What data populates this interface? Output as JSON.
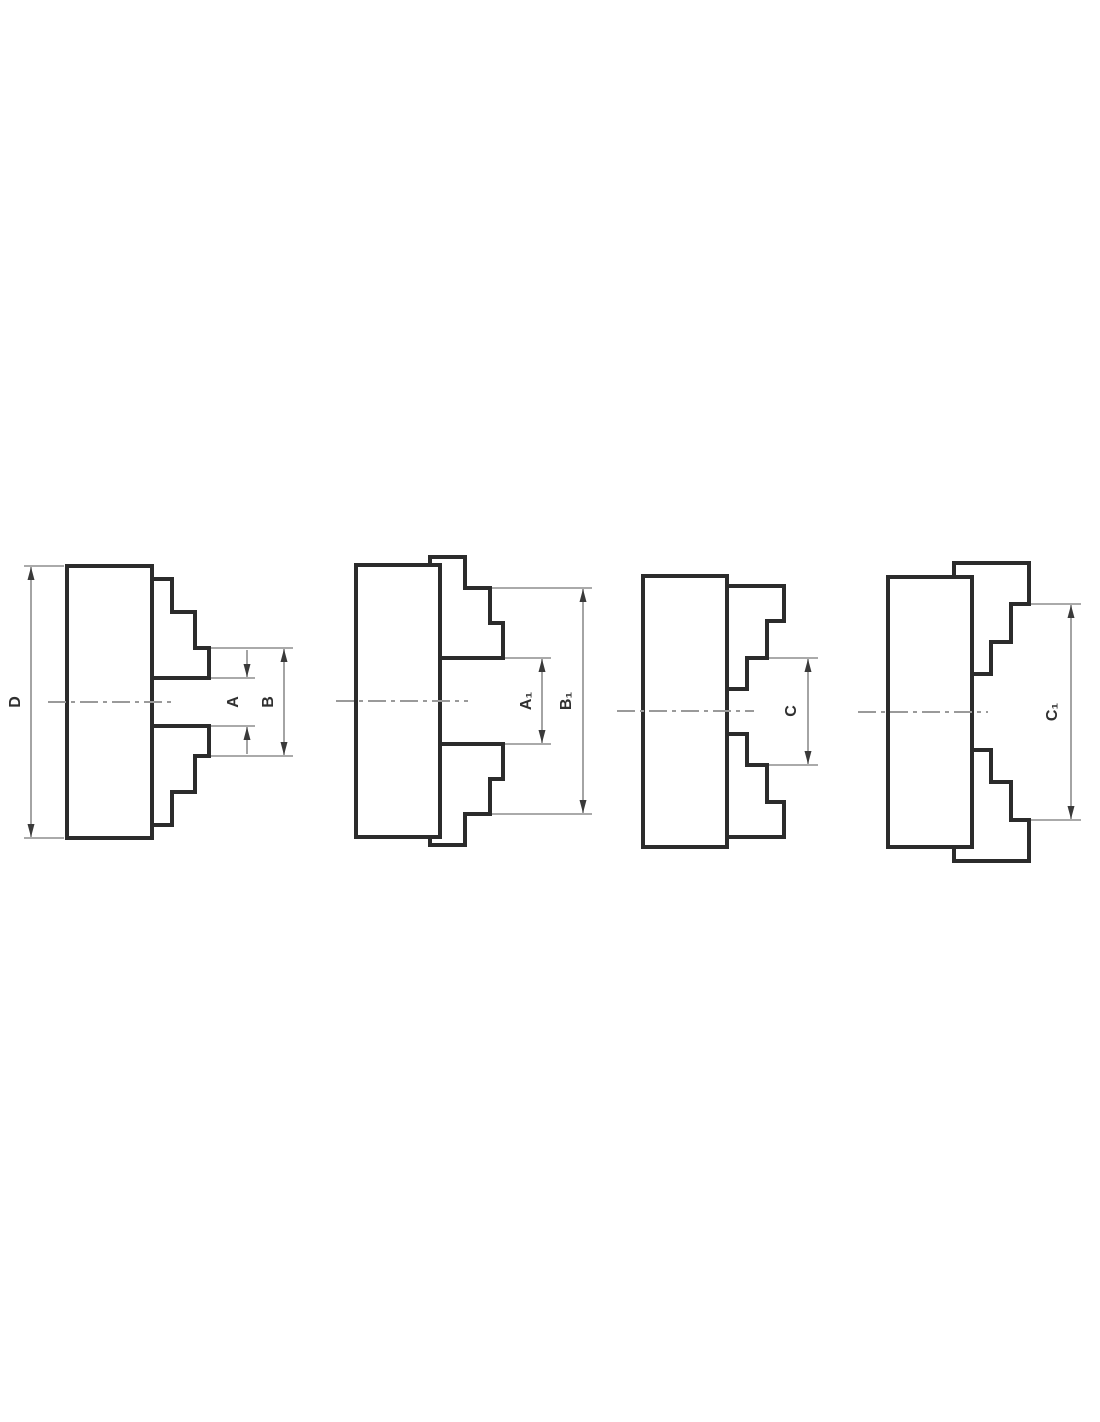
{
  "drawing": {
    "title": "chuck-jaw-clamping-diagrams",
    "colors": {
      "background": "#ffffff",
      "outline": "#2b2b2b",
      "dimension_lines": "#8d8d8d",
      "centerline": "#9a9a9a",
      "label_text": "#303030"
    }
  },
  "labels": {
    "d": "D",
    "a": "A",
    "b": "B",
    "a1": "A₁",
    "b1": "B₁",
    "c": "C",
    "c1": "C₁"
  }
}
